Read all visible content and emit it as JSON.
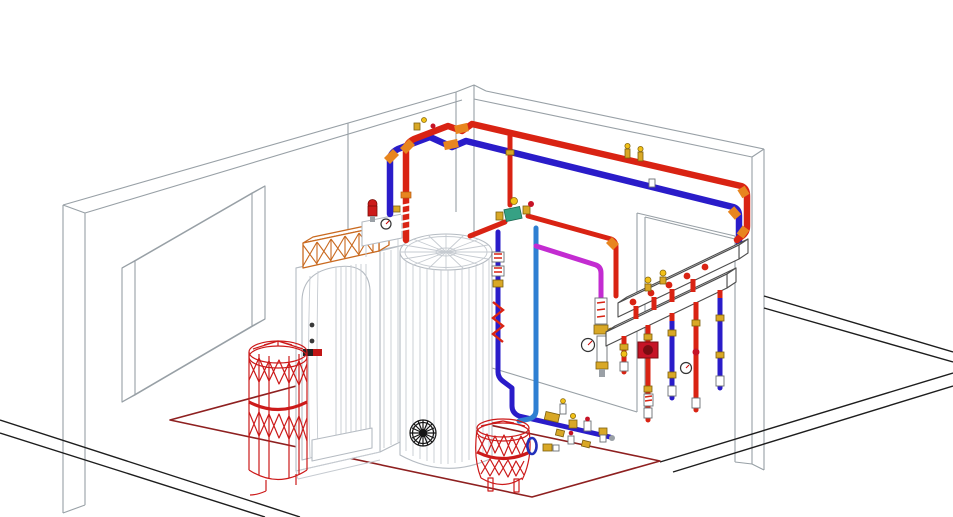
{
  "scene": {
    "description": "isometric-3d-cad-wireframe-boiler-room",
    "room": {
      "left_wall": "wireframe wall with recessed window opening",
      "right_wall": "wireframe wall with doorway opening and pier",
      "floor": "open floor with black edge lines and dark-red equipment plinth outline"
    }
  },
  "colors": {
    "background": "#ffffff",
    "wall_line": "#98a0a6",
    "floor_line": "#1d1d1d",
    "plinth": "#8e2020",
    "supply": "#d92313",
    "return": "#2a1cc9",
    "cold": "#2e7fd2",
    "mixed": "#c32cd1",
    "elbow": "#e8851f",
    "brass": "#d9a826",
    "tank_wire": "#cc1a1a",
    "pump": "#c61326",
    "valve_green": "#36a184",
    "truss": "#c96a20",
    "flange_blue": "#2230bb",
    "rosette": "#151515"
  },
  "components": [
    {
      "id": "boiler",
      "kind": "floor-standing-boiler"
    },
    {
      "id": "boiler-truss",
      "kind": "lattice-duct-on-boiler-top"
    },
    {
      "id": "buffer-tank",
      "kind": "vertical-storage-cylinder"
    },
    {
      "id": "expansion-tank-left",
      "kind": "red-wireframe-expansion-vessel"
    },
    {
      "id": "expansion-tank-center",
      "kind": "red-wireframe-expansion-vessel-on-legs"
    },
    {
      "id": "safety-valve-group",
      "kind": "boiler-top-safety-group-with-gauge"
    },
    {
      "id": "supply-pipe-main",
      "kind": "hot-supply-piping"
    },
    {
      "id": "return-pipe-main",
      "kind": "return-piping"
    },
    {
      "id": "cold-water-pipe",
      "kind": "cold-water-piping"
    },
    {
      "id": "mixed-water-pipe",
      "kind": "mixed-circuit-piping"
    },
    {
      "id": "distribution-manifold",
      "kind": "two-beam-supply-return-manifold"
    },
    {
      "id": "circulation-pump",
      "kind": "inline-pump-on-manifold-drop"
    },
    {
      "id": "mixing-station",
      "kind": "valve-stack-with-pressure-gauge"
    }
  ]
}
